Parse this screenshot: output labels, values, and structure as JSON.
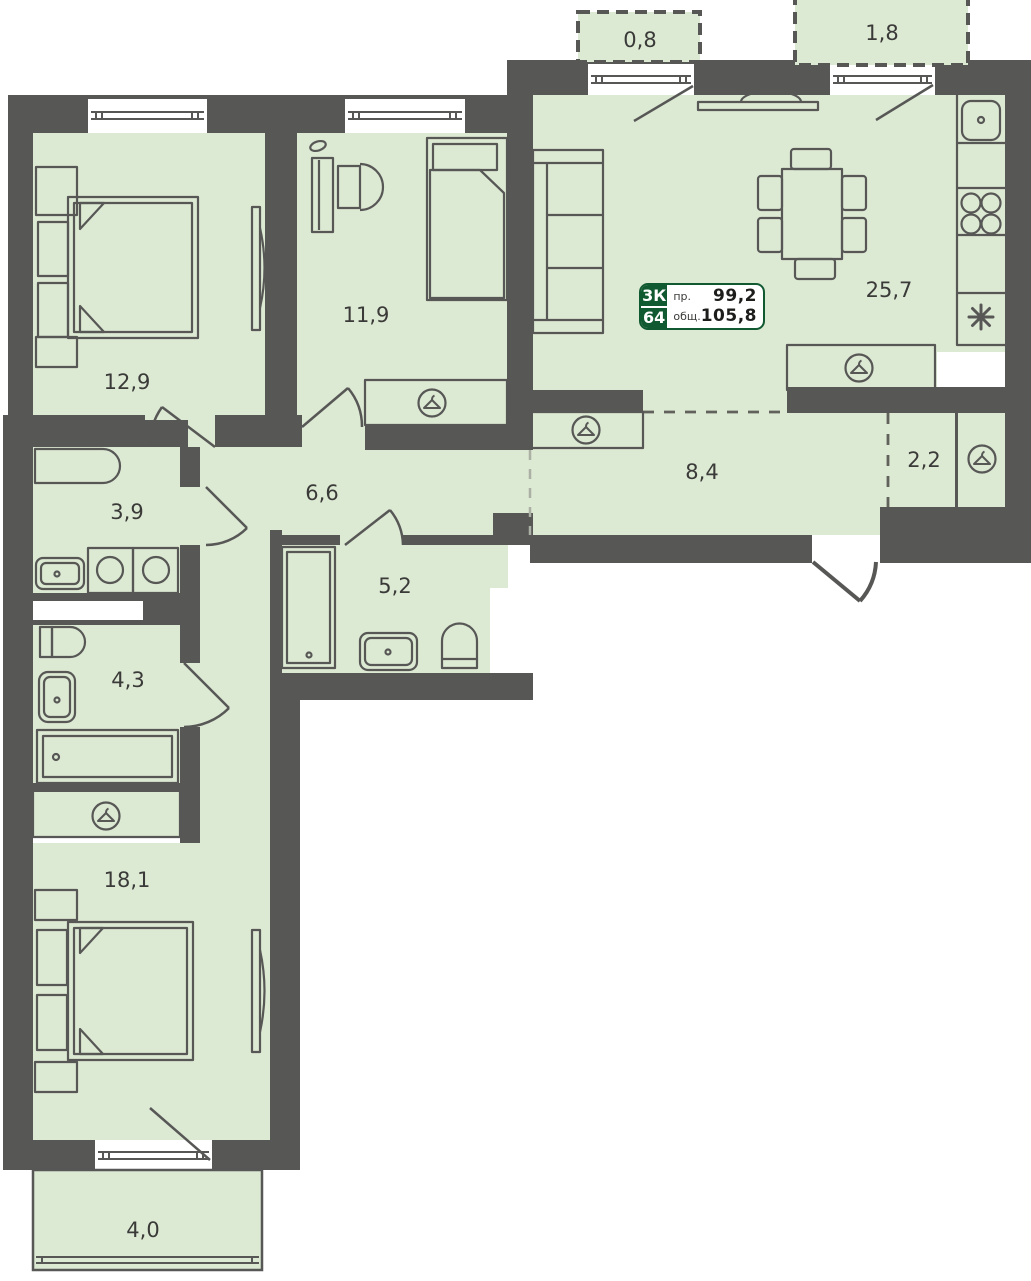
{
  "info_card": {
    "rooms_code": "3К",
    "unit_number": "64",
    "projected_label": "пр.",
    "projected_area": "99,2",
    "total_label": "общ.",
    "total_area": "105,8"
  },
  "rooms": {
    "balcony_top_left": {
      "area": "0,8"
    },
    "balcony_top_right": {
      "area": "1,8"
    },
    "bedroom_left": {
      "area": "12,9"
    },
    "room_middle": {
      "area": "11,9"
    },
    "kitchen_living": {
      "area": "25,7"
    },
    "bathroom_small": {
      "area": "3,9"
    },
    "hall": {
      "area": "6,6"
    },
    "corridor": {
      "area": "8,4"
    },
    "pantry": {
      "area": "2,2"
    },
    "bathroom_shower": {
      "area": "5,2"
    },
    "bathroom_lower": {
      "area": "4,3"
    },
    "bedroom_bottom": {
      "area": "18,1"
    },
    "balcony_bottom": {
      "area": "4,0"
    }
  },
  "icons": {
    "wardrobe": "hanger-icon",
    "fridge": "asterisk-icon",
    "stove": "four-burners-icon",
    "sink": "basin-icon"
  },
  "colors": {
    "room_fill": "#dce9d3",
    "wall": "#575756",
    "accent_green": "#115a31",
    "label_text": "#3a3a38"
  }
}
